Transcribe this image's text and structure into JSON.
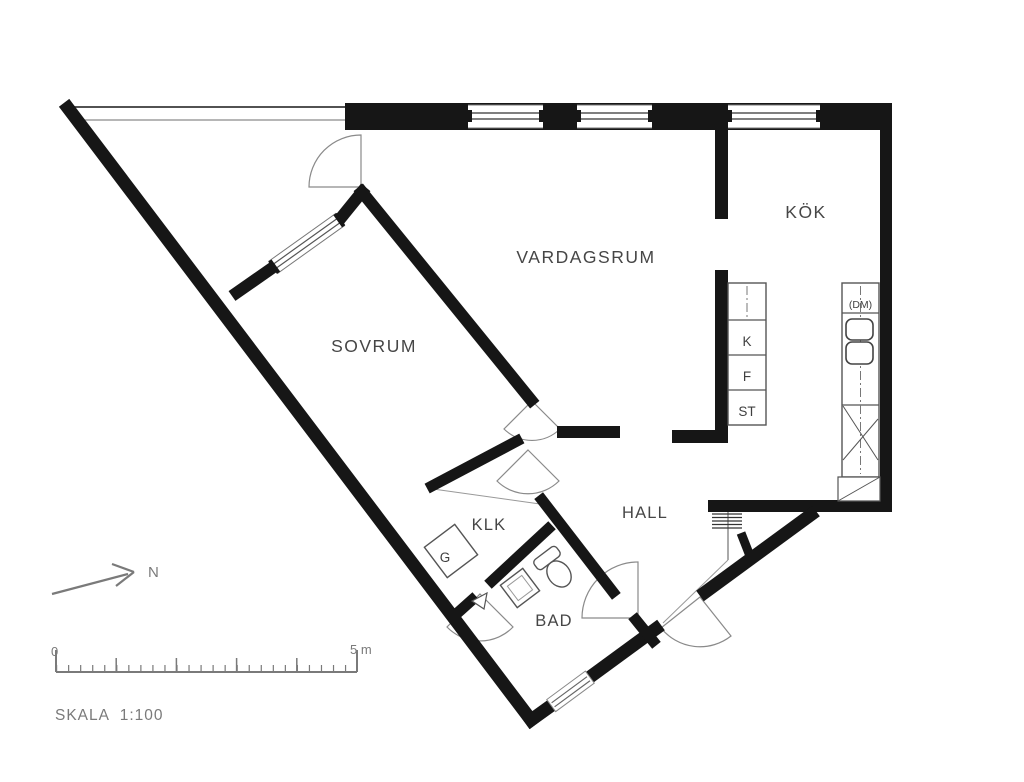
{
  "plan": {
    "rooms": {
      "vardagsrum": "VARDAGSRUM",
      "kok": "KÖK",
      "sovrum": "SOVRUM",
      "hall": "HALL",
      "klk": "KLK",
      "bad": "BAD"
    },
    "kitchen": {
      "dishwasher": "(DM)",
      "fridge": "K",
      "freezer": "F",
      "pantry": "ST"
    },
    "storage": {
      "wardrobe": "G"
    },
    "compass": {
      "north": "N"
    },
    "scalebar": {
      "zero": "0",
      "end": "5 m",
      "scale_text": "SKALA  1:100",
      "meters": 5,
      "minor_per_meter": 5
    },
    "colors": {
      "wall": "#161616",
      "thin_line": "#8a8a8a",
      "label": "#464646",
      "muted": "#7a7a7a",
      "background": "#ffffff"
    }
  }
}
